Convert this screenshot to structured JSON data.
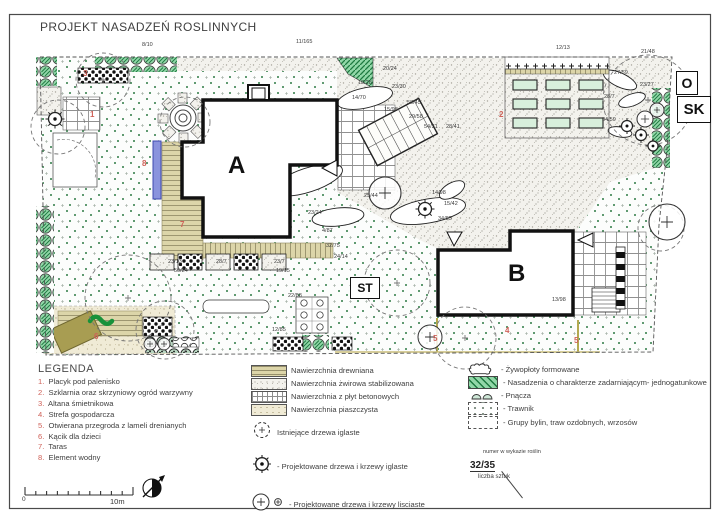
{
  "title": "PROJEKT NASADZEŃ ROSLINNYCH",
  "plan": {
    "labels": {
      "building_a": "A",
      "building_b": "B",
      "st": "ST",
      "o": "O",
      "sk": "SK"
    },
    "zone_markers": [
      {
        "n": "1",
        "x": 90,
        "y": 110
      },
      {
        "n": "2",
        "x": 499,
        "y": 110
      },
      {
        "n": "3",
        "x": 83,
        "y": 69
      },
      {
        "n": "4",
        "x": 505,
        "y": 326
      },
      {
        "n": "5",
        "x": 433,
        "y": 334
      },
      {
        "n": "5",
        "x": 574,
        "y": 336
      },
      {
        "n": "6",
        "x": 94,
        "y": 332
      },
      {
        "n": "7",
        "x": 180,
        "y": 220
      },
      {
        "n": "8",
        "x": 142,
        "y": 159
      }
    ],
    "plant_labels": [
      {
        "t": "8/10",
        "x": 142,
        "y": 42
      },
      {
        "t": "11/165",
        "x": 296,
        "y": 39
      },
      {
        "t": "12/13",
        "x": 556,
        "y": 45
      },
      {
        "t": "21/48",
        "x": 641,
        "y": 49
      },
      {
        "t": "20/24",
        "x": 383,
        "y": 66
      },
      {
        "t": "19/28",
        "x": 358,
        "y": 80
      },
      {
        "t": "23/30",
        "x": 392,
        "y": 84
      },
      {
        "t": "14/70",
        "x": 352,
        "y": 95
      },
      {
        "t": "58/45",
        "x": 407,
        "y": 100
      },
      {
        "t": "15/98",
        "x": 384,
        "y": 107
      },
      {
        "t": "29/58",
        "x": 409,
        "y": 114
      },
      {
        "t": "54/31",
        "x": 424,
        "y": 124
      },
      {
        "t": "28/41",
        "x": 446,
        "y": 124
      },
      {
        "t": "27/59",
        "x": 614,
        "y": 70
      },
      {
        "t": "28/7",
        "x": 604,
        "y": 94
      },
      {
        "t": "34/59",
        "x": 602,
        "y": 117
      },
      {
        "t": "23/27",
        "x": 640,
        "y": 82
      },
      {
        "t": "25/44",
        "x": 364,
        "y": 193
      },
      {
        "t": "14/98",
        "x": 432,
        "y": 190
      },
      {
        "t": "15/42",
        "x": 444,
        "y": 201
      },
      {
        "t": "34/85",
        "x": 438,
        "y": 216
      },
      {
        "t": "23/24",
        "x": 308,
        "y": 210
      },
      {
        "t": "4/87",
        "x": 322,
        "y": 228
      },
      {
        "t": "32/75",
        "x": 326,
        "y": 243
      },
      {
        "t": "24/14",
        "x": 334,
        "y": 254
      },
      {
        "t": "23/13",
        "x": 168,
        "y": 259
      },
      {
        "t": "50/24",
        "x": 174,
        "y": 268
      },
      {
        "t": "28/7",
        "x": 216,
        "y": 259
      },
      {
        "t": "23/7",
        "x": 274,
        "y": 259
      },
      {
        "t": "19/15",
        "x": 276,
        "y": 268
      },
      {
        "t": "22/88",
        "x": 288,
        "y": 293
      },
      {
        "t": "12/85",
        "x": 272,
        "y": 327
      },
      {
        "t": "13/98",
        "x": 552,
        "y": 297
      }
    ]
  },
  "legend": {
    "heading": "LEGENDA",
    "items": [
      {
        "n": "1",
        "label": "Placyk pod palenisko"
      },
      {
        "n": "2",
        "label": "Szklarnia oraz skrzyniowy ogród warzywny"
      },
      {
        "n": "3",
        "label": "Altana śmietnikowa"
      },
      {
        "n": "4",
        "label": "Strefa gospodarcza"
      },
      {
        "n": "5",
        "label": "Otwierana przegroda z lameli drenianych"
      },
      {
        "n": "6",
        "label": "Kącik dla dzieci"
      },
      {
        "n": "7",
        "label": "Taras"
      },
      {
        "n": "8",
        "label": "Element wodny"
      }
    ],
    "surfaces": [
      {
        "label": "Nawierzchnia drewniana",
        "pattern": "wood"
      },
      {
        "label": "Nawierzchnia żwirowa stabilizowana",
        "pattern": "gravel"
      },
      {
        "label": "Nawierzchnia z płyt betonowych",
        "pattern": "grid"
      },
      {
        "label": "Nawierzchnia piaszczysta",
        "pattern": "sand"
      }
    ],
    "trees": [
      {
        "label": "Istniejące drzewa iglaste",
        "icon": "existing-conifer"
      },
      {
        "label": "- Projektowane drzewa i krzewy iglaste",
        "icon": "proposed-conifer"
      },
      {
        "label": "- Projektowane drzewa i krzewy lisciaste",
        "icon": "proposed-deciduous"
      }
    ],
    "areas": [
      {
        "label": "- Żywopłoty formowane",
        "icon": "hedge"
      },
      {
        "label": "- Nasadzenia o charakterze zadarniającym- jednogatunkowe",
        "icon": "greenhatch"
      },
      {
        "label": "- Pnącza",
        "icon": "pnacza"
      },
      {
        "label": "- Trawnik",
        "icon": "trawnik"
      },
      {
        "label": "- Grupy bylin, traw ozdobnych, wrzosów",
        "icon": "grupy"
      }
    ],
    "plant_code": {
      "caption_top": "numer w wykazie roślin",
      "value": "32/35",
      "caption_bottom": "liczba sztuk"
    }
  },
  "scale": {
    "start": "0",
    "end": "10m"
  },
  "colors": {
    "hedge_green": "#92d7a8",
    "hatch_green": "#1e7a40",
    "lawn_dot": "#2e7a45",
    "water_blue": "#8a93dd",
    "marker_red": "#cf6158"
  }
}
